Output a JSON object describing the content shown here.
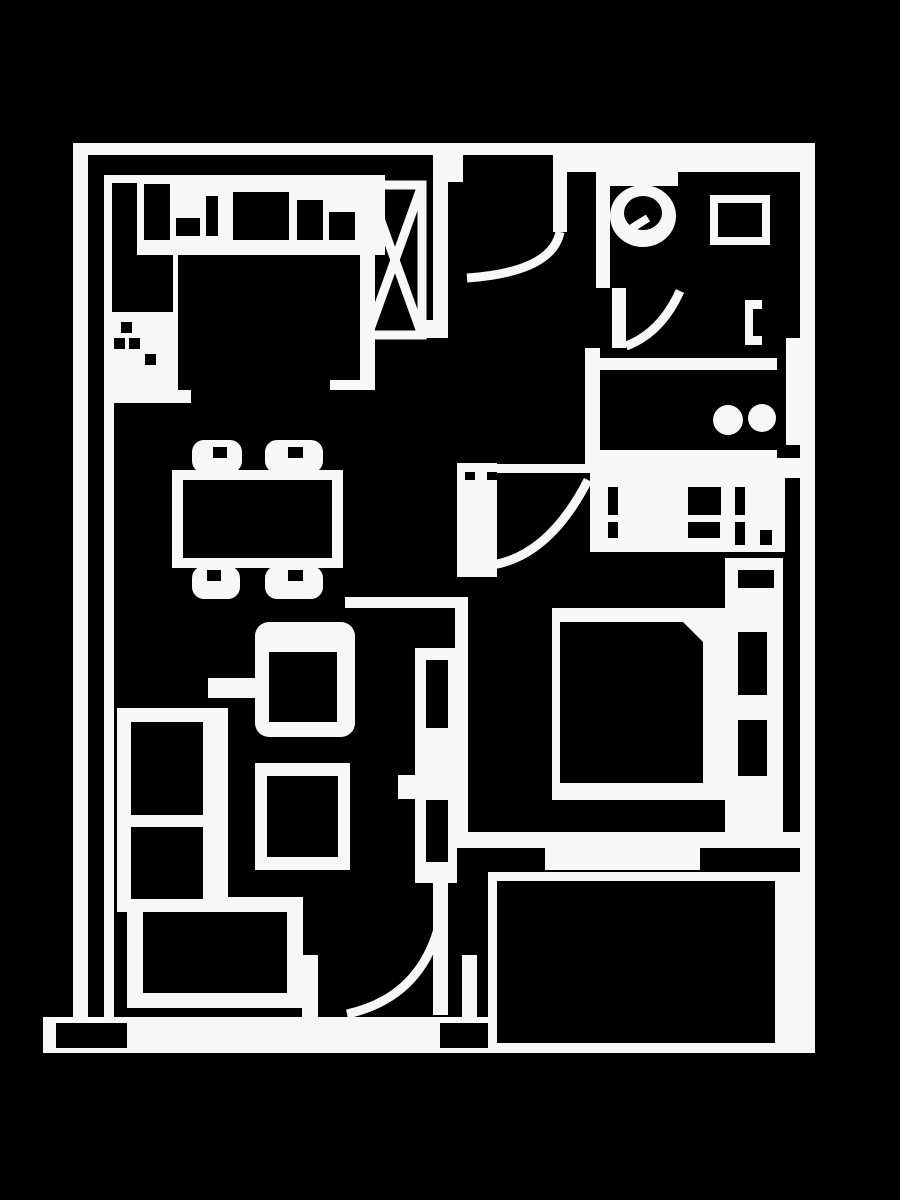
{
  "canvas": {
    "width": 900,
    "height": 1200,
    "background": "#000000",
    "line_color": "#f7f7f7"
  },
  "plan": {
    "kind": "apartment-floor-plan",
    "rooms": [
      "kitchen",
      "dining-area",
      "hallway",
      "bathroom",
      "laundry",
      "bedroom",
      "living-room",
      "balcony",
      "terrace"
    ],
    "shapes": [
      {
        "name": "wall-left-outer",
        "type": "rect",
        "x": 73,
        "y": 143,
        "w": 15,
        "h": 874
      },
      {
        "name": "wall-top",
        "type": "rect",
        "x": 73,
        "y": 143,
        "w": 742,
        "h": 12
      },
      {
        "name": "wall-top-right-thick",
        "type": "rect",
        "x": 560,
        "y": 143,
        "w": 255,
        "h": 29
      },
      {
        "name": "wall-entry-stub",
        "type": "rect",
        "x": 448,
        "y": 143,
        "w": 15,
        "h": 39
      },
      {
        "name": "wall-right-outer",
        "type": "rect",
        "x": 800,
        "y": 143,
        "w": 15,
        "h": 910
      },
      {
        "name": "wall-hall-divider",
        "type": "rect",
        "x": 433,
        "y": 152,
        "w": 15,
        "h": 186
      },
      {
        "name": "wall-hall-divider-foot",
        "type": "rect",
        "x": 418,
        "y": 320,
        "w": 15,
        "h": 18
      },
      {
        "name": "wall-bathroom-left",
        "type": "rect",
        "x": 596,
        "y": 155,
        "w": 14,
        "h": 133
      },
      {
        "name": "wall-bathroom-bottom",
        "type": "rect",
        "x": 585,
        "y": 358,
        "w": 192,
        "h": 12
      },
      {
        "name": "wall-laundry-left",
        "type": "rect",
        "x": 585,
        "y": 348,
        "w": 15,
        "h": 124
      },
      {
        "name": "wall-laundry-bottom",
        "type": "rect",
        "x": 596,
        "y": 450,
        "w": 181,
        "h": 12
      },
      {
        "name": "wall-bedroom-top",
        "type": "rect",
        "x": 590,
        "y": 458,
        "w": 210,
        "h": 20
      },
      {
        "name": "bedroom-threshold",
        "type": "rect",
        "x": 457,
        "y": 464,
        "w": 163,
        "h": 9
      },
      {
        "name": "wall-bedroom-left-upper",
        "type": "rect",
        "x": 457,
        "y": 463,
        "w": 40,
        "h": 114
      },
      {
        "name": "wall-bedroom-left-lower",
        "type": "rect",
        "x": 455,
        "y": 597,
        "w": 13,
        "h": 251
      },
      {
        "name": "wall-dining-return",
        "type": "rect",
        "x": 345,
        "y": 597,
        "w": 123,
        "h": 11
      },
      {
        "name": "wall-balcony-band",
        "type": "rect",
        "x": 455,
        "y": 832,
        "w": 352,
        "h": 16
      },
      {
        "name": "balcony-sliding-panel",
        "type": "rect",
        "x": 545,
        "y": 848,
        "w": 155,
        "h": 22
      },
      {
        "name": "balcony-door-track",
        "type": "rect",
        "x": 433,
        "y": 798,
        "w": 15,
        "h": 217
      },
      {
        "name": "wall-terrace-band",
        "type": "rect",
        "x": 43,
        "y": 1017,
        "w": 772,
        "h": 36
      },
      {
        "name": "wall-stub-left-jamb",
        "type": "rect",
        "x": 302,
        "y": 955,
        "w": 16,
        "h": 62
      },
      {
        "name": "wall-stub-right-jamb",
        "type": "rect",
        "x": 462,
        "y": 955,
        "w": 15,
        "h": 62
      },
      {
        "name": "wall-left-inner-line",
        "type": "rect",
        "x": 104,
        "y": 175,
        "w": 10,
        "h": 842
      },
      {
        "name": "kitchen-cap-left",
        "type": "rect",
        "x": 104,
        "y": 390,
        "w": 87,
        "h": 13
      },
      {
        "name": "kitchen-cap-right",
        "type": "rect",
        "x": 330,
        "y": 380,
        "w": 45,
        "h": 10
      },
      {
        "name": "kitchen-right-bar",
        "type": "rect",
        "x": 360,
        "y": 255,
        "w": 15,
        "h": 135
      },
      {
        "name": "laundry-door-leaf",
        "type": "rect",
        "x": 786,
        "y": 338,
        "w": 14,
        "h": 107
      },
      {
        "name": "bathroom-door-leaf",
        "type": "rect",
        "x": 612,
        "y": 288,
        "w": 14,
        "h": 60
      },
      {
        "name": "entrance-door-leaf",
        "type": "rect",
        "x": 553,
        "y": 150,
        "w": 14,
        "h": 82
      },
      {
        "name": "kitchen-counter",
        "type": "rect",
        "x": 104,
        "y": 175,
        "w": 281,
        "h": 80
      },
      {
        "name": "kitchen-counter-left-run",
        "type": "rect",
        "x": 104,
        "y": 175,
        "w": 74,
        "h": 223
      },
      {
        "name": "balcony-frame",
        "type": "rect",
        "x": 488,
        "y": 872,
        "w": 327,
        "h": 181
      },
      {
        "name": "wardrobe",
        "type": "rect",
        "x": 590,
        "y": 477,
        "w": 195,
        "h": 75
      },
      {
        "name": "bed-frame",
        "type": "rect",
        "x": 552,
        "y": 608,
        "w": 178,
        "h": 192
      },
      {
        "name": "bed-headboard",
        "type": "rect",
        "x": 725,
        "y": 558,
        "w": 58,
        "h": 275
      },
      {
        "name": "shelf-unit",
        "type": "rect",
        "x": 415,
        "y": 648,
        "w": 42,
        "h": 235
      },
      {
        "name": "shelf-arm",
        "type": "rect",
        "x": 398,
        "y": 775,
        "w": 20,
        "h": 24
      },
      {
        "name": "sofa",
        "type": "rect",
        "x": 117,
        "y": 708,
        "w": 111,
        "h": 204
      },
      {
        "name": "tv-bench",
        "type": "rect",
        "x": 127,
        "y": 897,
        "w": 176,
        "h": 111
      },
      {
        "name": "coffee-table",
        "type": "rect",
        "x": 255,
        "y": 763,
        "w": 95,
        "h": 107
      },
      {
        "name": "side-table",
        "type": "rect",
        "x": 208,
        "y": 678,
        "w": 50,
        "h": 20
      },
      {
        "name": "dining-table",
        "type": "rect",
        "x": 172,
        "y": 470,
        "w": 171,
        "h": 98
      },
      {
        "name": "toilet-tank",
        "type": "rect",
        "x": 609,
        "y": 160,
        "w": 69,
        "h": 26
      },
      {
        "name": "bathroom-sink",
        "type": "rect",
        "x": 710,
        "y": 195,
        "w": 60,
        "h": 50
      },
      {
        "name": "towel-bracket-bar",
        "type": "rect",
        "x": 745,
        "y": 300,
        "w": 8,
        "h": 45
      },
      {
        "name": "towel-bracket-top",
        "type": "rect",
        "x": 753,
        "y": 300,
        "w": 9,
        "h": 9
      },
      {
        "name": "towel-bracket-bottom",
        "type": "rect",
        "x": 753,
        "y": 336,
        "w": 9,
        "h": 9
      },
      {
        "name": "armchair",
        "type": "rrect",
        "x": 255,
        "y": 622,
        "w": 100,
        "h": 115,
        "r": 14
      },
      {
        "name": "dining-chair-top-left",
        "type": "rrect",
        "x": 192,
        "y": 440,
        "w": 50,
        "h": 33,
        "r": 12
      },
      {
        "name": "dining-chair-top-right",
        "type": "rrect",
        "x": 265,
        "y": 440,
        "w": 58,
        "h": 33,
        "r": 12
      },
      {
        "name": "dining-chair-bottom-left",
        "type": "rrect",
        "x": 192,
        "y": 566,
        "w": 48,
        "h": 33,
        "r": 12
      },
      {
        "name": "dining-chair-bottom-right",
        "type": "rrect",
        "x": 265,
        "y": 566,
        "w": 58,
        "h": 33,
        "r": 12
      },
      {
        "name": "toilet-bowl",
        "type": "ellipse",
        "cx": 643,
        "cy": 216,
        "rx": 33,
        "ry": 31
      },
      {
        "name": "washer-drum",
        "type": "circle",
        "cx": 728,
        "cy": 420,
        "r": 15
      },
      {
        "name": "washer-drum-2",
        "type": "circle",
        "cx": 762,
        "cy": 418,
        "r": 14
      },
      {
        "name": "balcony-floor",
        "type": "rect",
        "x": 497,
        "y": 881,
        "w": 278,
        "h": 162,
        "fill": "bg"
      },
      {
        "name": "counter-block-tall",
        "type": "rect",
        "x": 112,
        "y": 183,
        "w": 25,
        "h": 129,
        "fill": "bg"
      },
      {
        "name": "counter-block-2",
        "type": "rect",
        "x": 144,
        "y": 184,
        "w": 26,
        "h": 56,
        "fill": "bg"
      },
      {
        "name": "counter-block-step",
        "type": "rect",
        "x": 176,
        "y": 218,
        "w": 24,
        "h": 18,
        "fill": "bg"
      },
      {
        "name": "counter-block-small",
        "type": "rect",
        "x": 206,
        "y": 196,
        "w": 12,
        "h": 40,
        "fill": "bg"
      },
      {
        "name": "counter-block-sink",
        "type": "rect",
        "x": 233,
        "y": 192,
        "w": 56,
        "h": 48,
        "fill": "bg"
      },
      {
        "name": "counter-block-right-a",
        "type": "rect",
        "x": 297,
        "y": 200,
        "w": 26,
        "h": 40,
        "fill": "bg"
      },
      {
        "name": "counter-block-right-b",
        "type": "rect",
        "x": 329,
        "y": 212,
        "w": 26,
        "h": 28,
        "fill": "bg"
      },
      {
        "name": "counter-cabinet-left",
        "type": "rect",
        "x": 112,
        "y": 255,
        "w": 61,
        "h": 57,
        "fill": "bg"
      },
      {
        "name": "cooktop-burner-1",
        "type": "rect",
        "x": 121,
        "y": 322,
        "w": 11,
        "h": 11,
        "fill": "bg"
      },
      {
        "name": "cooktop-burner-2",
        "type": "rect",
        "x": 114,
        "y": 338,
        "w": 11,
        "h": 11,
        "fill": "bg"
      },
      {
        "name": "cooktop-burner-3",
        "type": "rect",
        "x": 129,
        "y": 338,
        "w": 11,
        "h": 11,
        "fill": "bg"
      },
      {
        "name": "cooktop-burner-4",
        "type": "rect",
        "x": 145,
        "y": 354,
        "w": 11,
        "h": 11,
        "fill": "bg"
      },
      {
        "name": "terrace-notch-left",
        "type": "rect",
        "x": 56,
        "y": 1023,
        "w": 71,
        "h": 25,
        "fill": "bg"
      },
      {
        "name": "terrace-notch-right",
        "type": "rect",
        "x": 440,
        "y": 1023,
        "w": 48,
        "h": 25,
        "fill": "bg"
      },
      {
        "name": "threshold-notch-1",
        "type": "rect",
        "x": 465,
        "y": 472,
        "w": 10,
        "h": 8,
        "fill": "bg"
      },
      {
        "name": "threshold-notch-2",
        "type": "rect",
        "x": 487,
        "y": 472,
        "w": 10,
        "h": 8,
        "fill": "bg"
      },
      {
        "name": "wardrobe-mark-1",
        "type": "rect",
        "x": 608,
        "y": 487,
        "w": 10,
        "h": 28,
        "fill": "bg"
      },
      {
        "name": "wardrobe-mark-2",
        "type": "rect",
        "x": 608,
        "y": 522,
        "w": 10,
        "h": 16,
        "fill": "bg"
      },
      {
        "name": "wardrobe-mark-3",
        "type": "rect",
        "x": 688,
        "y": 487,
        "w": 33,
        "h": 28,
        "fill": "bg"
      },
      {
        "name": "wardrobe-mark-4",
        "type": "rect",
        "x": 688,
        "y": 522,
        "w": 32,
        "h": 16,
        "fill": "bg"
      },
      {
        "name": "wardrobe-mark-5",
        "type": "rect",
        "x": 735,
        "y": 487,
        "w": 10,
        "h": 28,
        "fill": "bg"
      },
      {
        "name": "wardrobe-mark-6",
        "type": "rect",
        "x": 735,
        "y": 522,
        "w": 10,
        "h": 23,
        "fill": "bg"
      },
      {
        "name": "wardrobe-mark-7",
        "type": "rect",
        "x": 760,
        "y": 530,
        "w": 12,
        "h": 15,
        "fill": "bg"
      },
      {
        "name": "bed-mattress",
        "type": "path",
        "d": "M560,622 L683,622 L703,642 L703,783 L560,783 Z",
        "fill": "bg"
      },
      {
        "name": "headboard-mark",
        "type": "rect",
        "x": 738,
        "y": 570,
        "w": 36,
        "h": 18,
        "fill": "bg"
      },
      {
        "name": "pillow-1",
        "type": "rect",
        "x": 738,
        "y": 632,
        "w": 29,
        "h": 63,
        "fill": "bg"
      },
      {
        "name": "pillow-2",
        "type": "rect",
        "x": 738,
        "y": 720,
        "w": 29,
        "h": 56,
        "fill": "bg"
      },
      {
        "name": "shelf-slot-1",
        "type": "rect",
        "x": 426,
        "y": 660,
        "w": 22,
        "h": 68,
        "fill": "bg"
      },
      {
        "name": "shelf-slot-2",
        "type": "rect",
        "x": 426,
        "y": 800,
        "w": 22,
        "h": 62,
        "fill": "bg"
      },
      {
        "name": "sofa-cushion-1",
        "type": "rect",
        "x": 131,
        "y": 722,
        "w": 72,
        "h": 93,
        "fill": "bg"
      },
      {
        "name": "sofa-cushion-2",
        "type": "rect",
        "x": 131,
        "y": 827,
        "w": 72,
        "h": 72,
        "fill": "bg"
      },
      {
        "name": "tv-bench-top",
        "type": "rect",
        "x": 143,
        "y": 912,
        "w": 144,
        "h": 81,
        "fill": "bg"
      },
      {
        "name": "armchair-seat",
        "type": "rect",
        "x": 269,
        "y": 652,
        "w": 68,
        "h": 70,
        "fill": "bg"
      },
      {
        "name": "coffee-table-top",
        "type": "rect",
        "x": 267,
        "y": 776,
        "w": 71,
        "h": 81,
        "fill": "bg"
      },
      {
        "name": "dining-table-top",
        "type": "rect",
        "x": 183,
        "y": 480,
        "w": 149,
        "h": 78,
        "fill": "bg"
      },
      {
        "name": "chair-notch-1",
        "type": "rect",
        "x": 213,
        "y": 447,
        "w": 14,
        "h": 11,
        "fill": "bg"
      },
      {
        "name": "chair-notch-2",
        "type": "rect",
        "x": 288,
        "y": 447,
        "w": 15,
        "h": 11,
        "fill": "bg"
      },
      {
        "name": "chair-notch-3",
        "type": "rect",
        "x": 207,
        "y": 570,
        "w": 14,
        "h": 11,
        "fill": "bg"
      },
      {
        "name": "chair-notch-4",
        "type": "rect",
        "x": 288,
        "y": 570,
        "w": 15,
        "h": 11,
        "fill": "bg"
      },
      {
        "name": "sink-basin",
        "type": "rect",
        "x": 718,
        "y": 203,
        "w": 44,
        "h": 34,
        "fill": "bg"
      },
      {
        "name": "toilet-bowl-inner",
        "type": "ellipse",
        "cx": 643,
        "cy": 213,
        "rx": 19,
        "ry": 17,
        "fill": "bg"
      },
      {
        "name": "toilet-seat-tick",
        "type": "line",
        "x1": 632,
        "y1": 228,
        "x2": 648,
        "y2": 218,
        "stroke": 8
      },
      {
        "name": "entrance-door-arc",
        "type": "path",
        "d": "M560,232 Q552,272 467,278",
        "stroke": 9
      },
      {
        "name": "bedroom-door-arc",
        "type": "path",
        "d": "M492,565 Q549,556 588,480",
        "stroke": 9
      },
      {
        "name": "bathroom-door-arc",
        "type": "path",
        "d": "M626,346 Q661,333 680,291",
        "stroke": 9
      },
      {
        "name": "balcony-door-arc",
        "type": "path",
        "d": "M441,917 Q424,997 347,1014",
        "stroke": 9
      },
      {
        "name": "shaft-box",
        "type": "rect-stroke",
        "x": 368,
        "y": 185,
        "w": 54,
        "h": 150,
        "stroke": 9
      },
      {
        "name": "shaft-x-diagonal-1",
        "type": "line",
        "x1": 368,
        "y1": 185,
        "x2": 422,
        "y2": 335,
        "stroke": 9
      },
      {
        "name": "shaft-x-diagonal-2",
        "type": "line",
        "x1": 422,
        "y1": 185,
        "x2": 368,
        "y2": 335,
        "stroke": 9
      }
    ]
  }
}
